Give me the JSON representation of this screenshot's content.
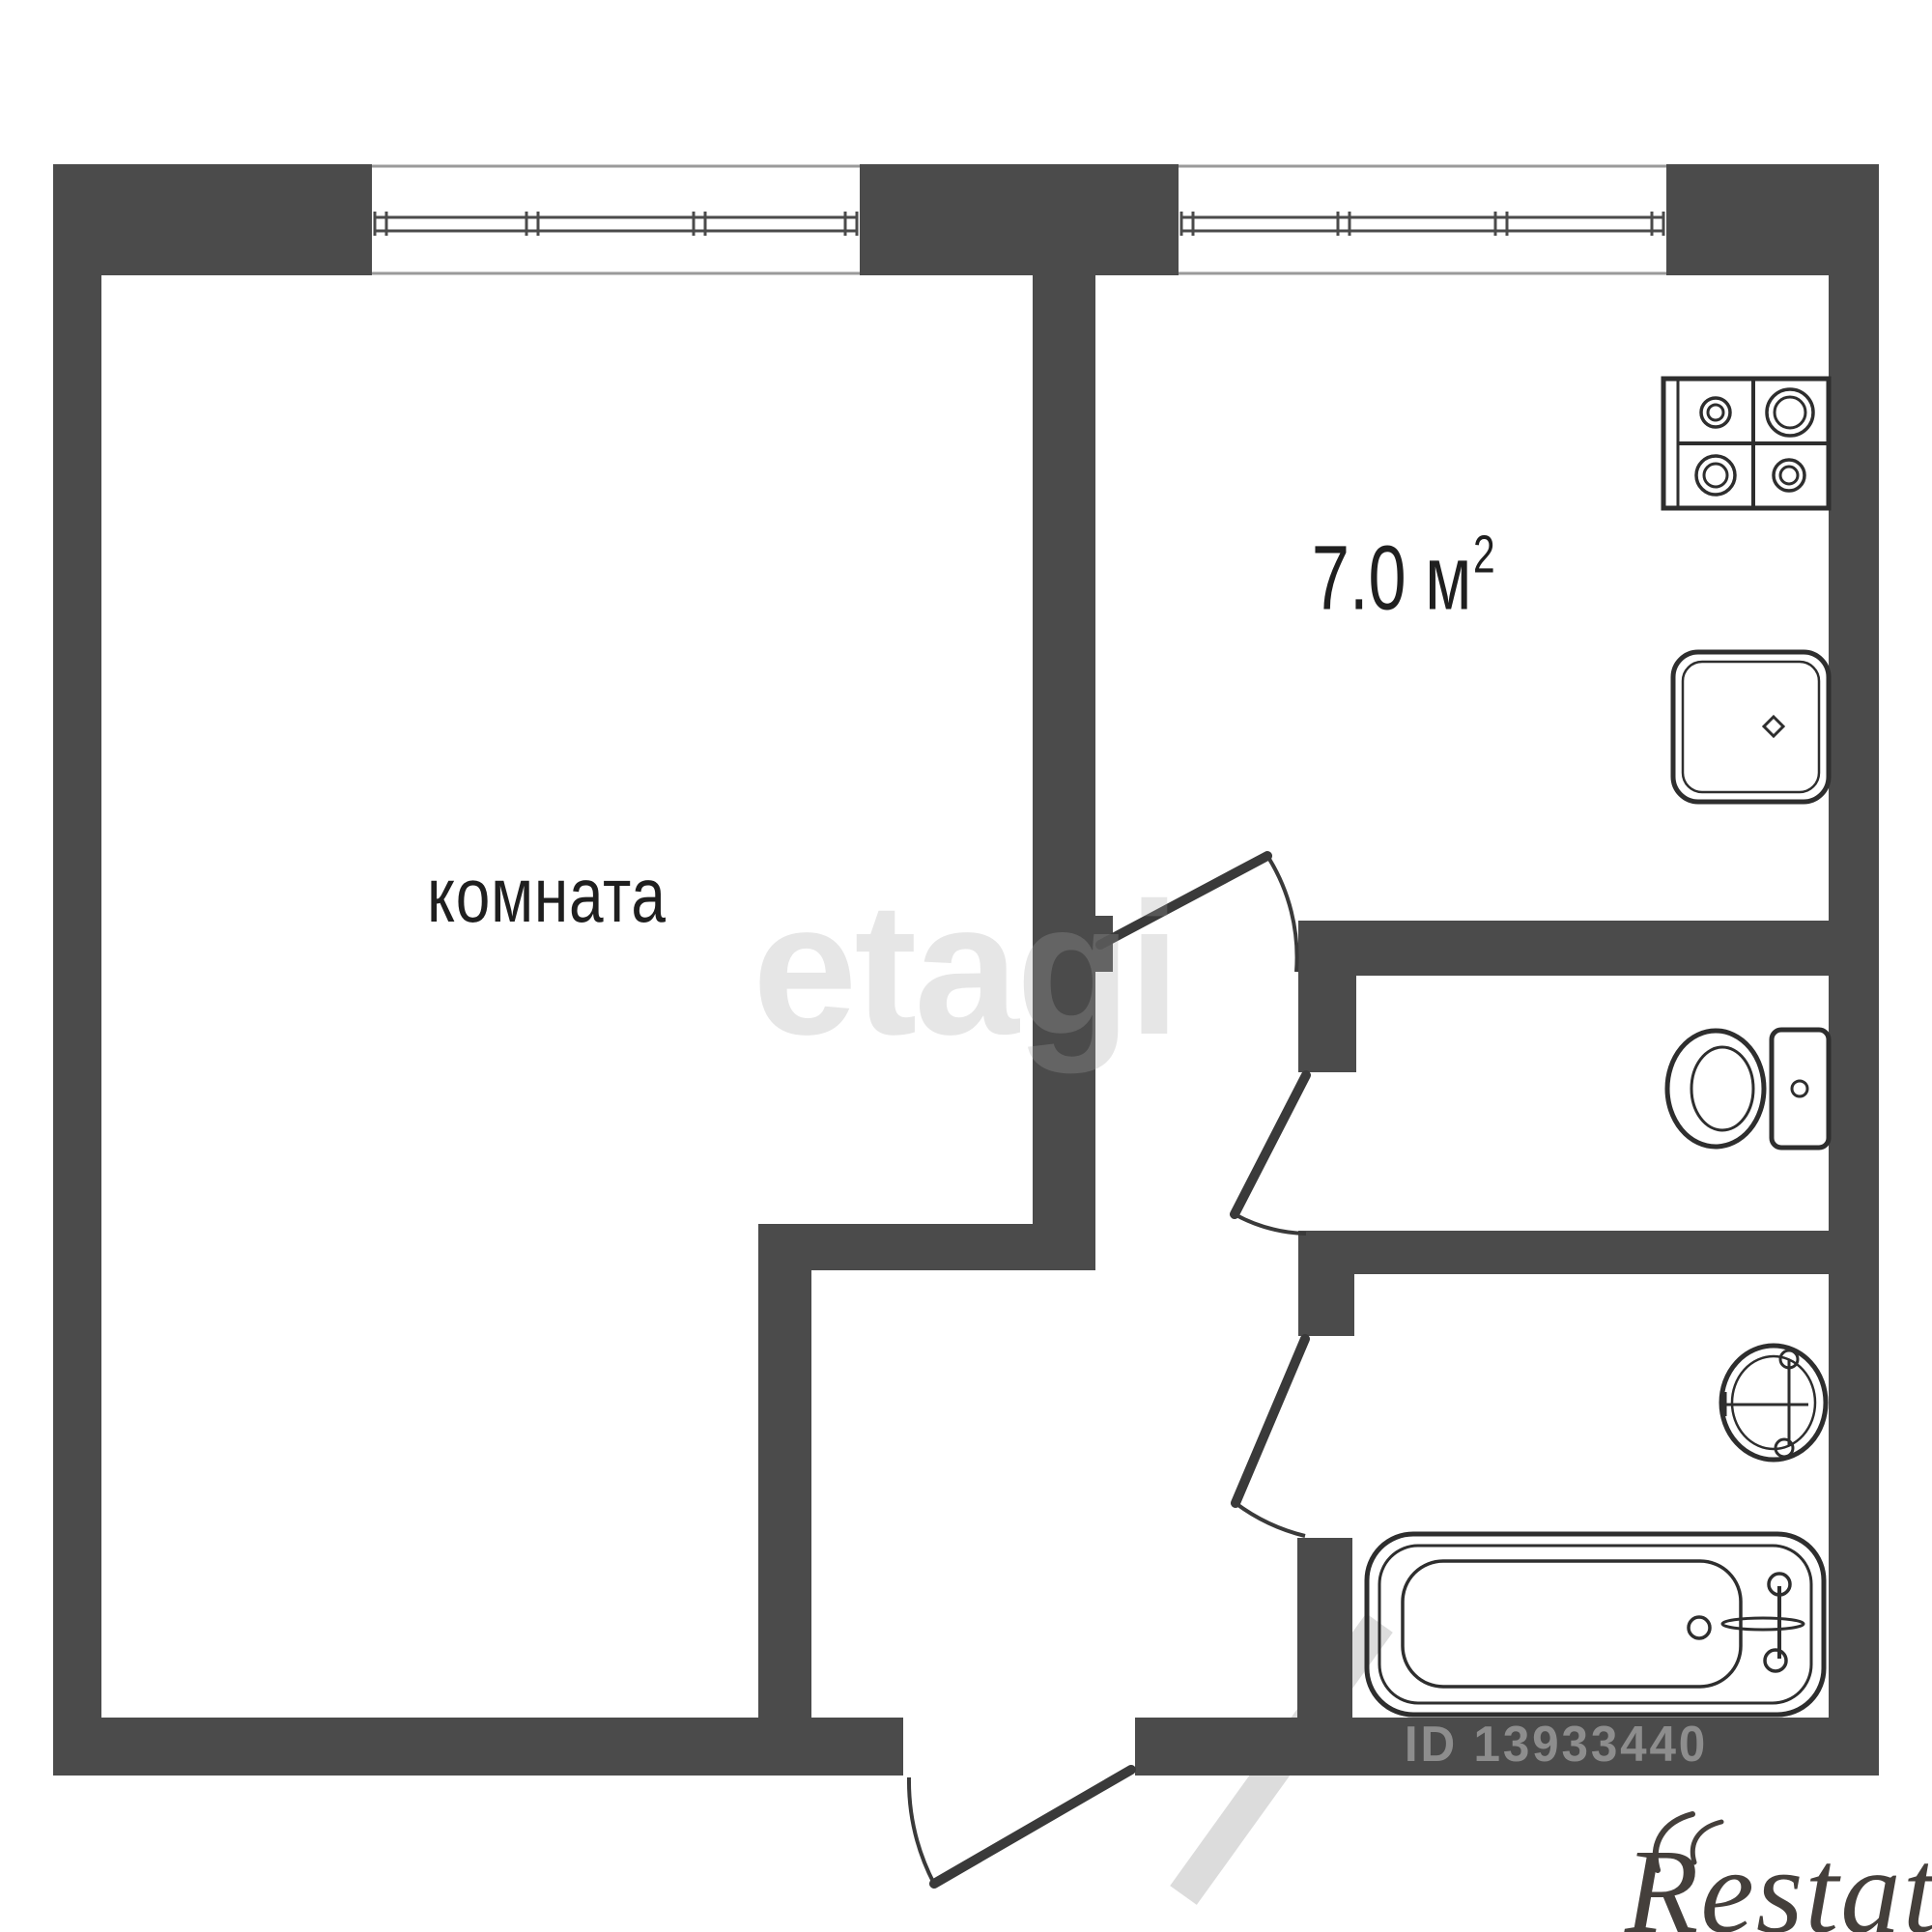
{
  "labels": {
    "room": "комната",
    "kitchen_area": "7.0 м",
    "kitchen_area_exponent": "2"
  },
  "watermarks": {
    "center_brand": "etagi",
    "listing_id": "ID 13933440",
    "corner_brand": "Restate"
  },
  "colors": {
    "wall": "#4b4b4b",
    "line": "#2e2e2e",
    "door": "#3a3a3a",
    "text": "#1f1f1f",
    "wm_light": "rgba(165,165,165,0.28)",
    "wm_mid": "rgba(182,182,182,0.62)",
    "wm_stripe": "rgba(185,185,185,0.5)",
    "brand": "#443f3b"
  },
  "icons": [
    "room-window-icon",
    "kitchen-window-icon",
    "entry-door-icon",
    "kitchen-door-icon",
    "toilet-door-icon",
    "bathroom-door-icon",
    "stove-icon",
    "kitchen-sink-icon",
    "toilet-icon",
    "washbasin-icon",
    "bathtub-icon",
    "watermark-arrow-icon"
  ]
}
